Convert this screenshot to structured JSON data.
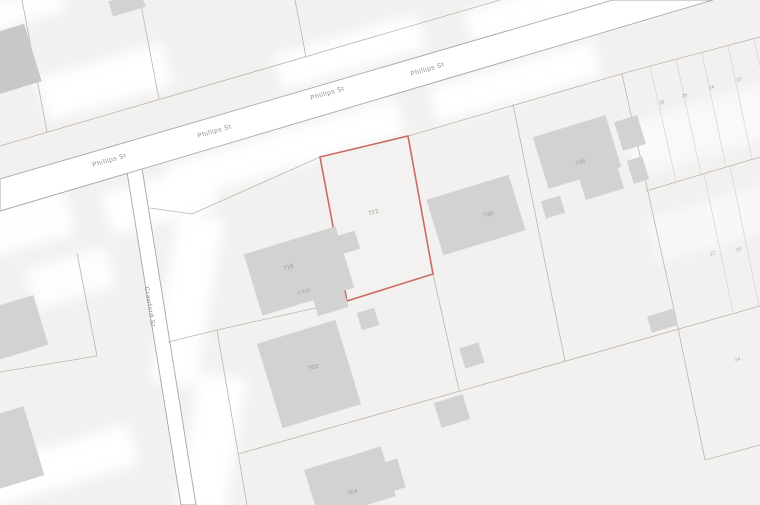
{
  "map": {
    "streets": {
      "phillips_label": "Phillips St",
      "crawford_label": "Crawford St"
    },
    "subject_parcel": {
      "label": "722",
      "outline_color": "#c96a64"
    },
    "parcel_labels": {
      "n716": "716",
      "v818": "V 818",
      "n730": "730",
      "n736": "736",
      "n702": "702",
      "n704": "704"
    },
    "lot_numbers": {
      "a": "18",
      "b": "26",
      "c": "24",
      "d": "13",
      "e": "17",
      "f": "15",
      "g": "24"
    },
    "colors": {
      "background": "#f3f1ef",
      "road_fill": "#ffffff",
      "parcel_line": "#b9b5b1",
      "building_fill": "#d3d2d1",
      "label_text": "#9c9995",
      "subject_outline": "#c96a64"
    }
  }
}
